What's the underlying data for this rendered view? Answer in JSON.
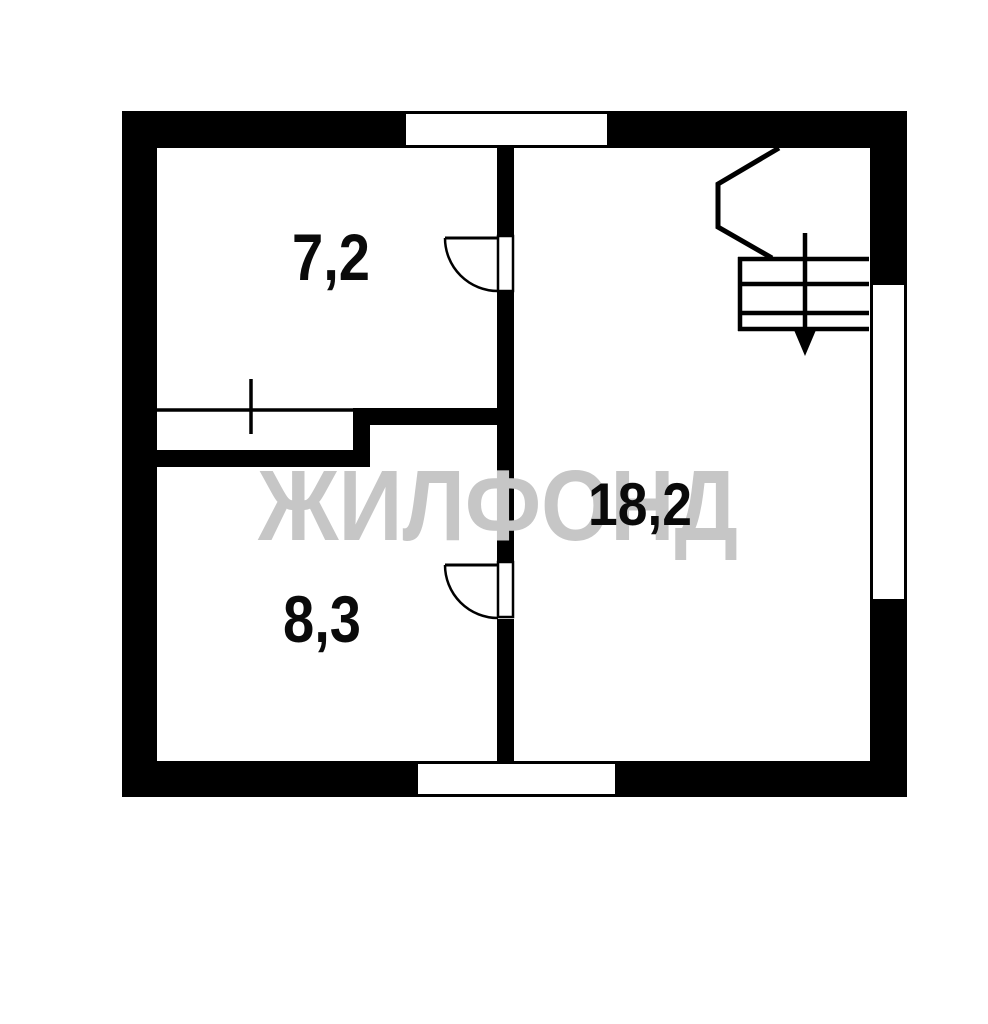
{
  "watermark": {
    "text": "ЖИЛФОНД",
    "color": "#c6c6c6"
  },
  "rooms": [
    {
      "id": "room-top-left",
      "area": "7,2"
    },
    {
      "id": "room-bottom-left",
      "area": "8,3"
    },
    {
      "id": "room-right",
      "area": "18,2"
    }
  ],
  "colors": {
    "wall": "#000000",
    "line": "#000000",
    "background": "#ffffff"
  }
}
